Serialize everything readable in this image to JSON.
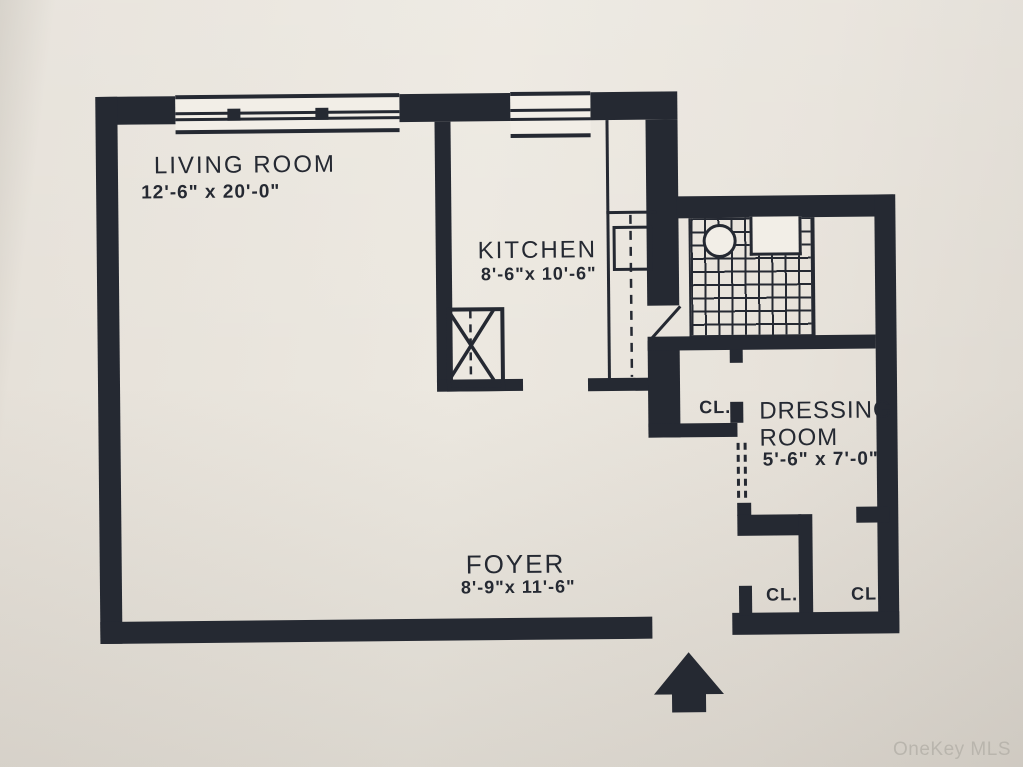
{
  "colors": {
    "ink": "#252932",
    "paper": "#e9e4dc",
    "window_fill": "#f2eee7",
    "watermark": "#b9b5ad"
  },
  "rooms": {
    "living_room": {
      "name": "LIVING ROOM",
      "dims": "12'-6\" x 20'-0\""
    },
    "kitchen": {
      "name": "KITCHEN",
      "dims": "8'-6\"x 10'-6\""
    },
    "dressing_room": {
      "name_line1": "DRESSING",
      "name_line2": "ROOM",
      "dims": "5'-6\" x 7'-0\""
    },
    "foyer": {
      "name": "FOYER",
      "dims": "8'-9\"x 11'-6\""
    }
  },
  "closets": {
    "dressing": "CL.",
    "bottom_left": "CL.",
    "bottom_right": "CL."
  },
  "watermark": "OneKey MLS"
}
